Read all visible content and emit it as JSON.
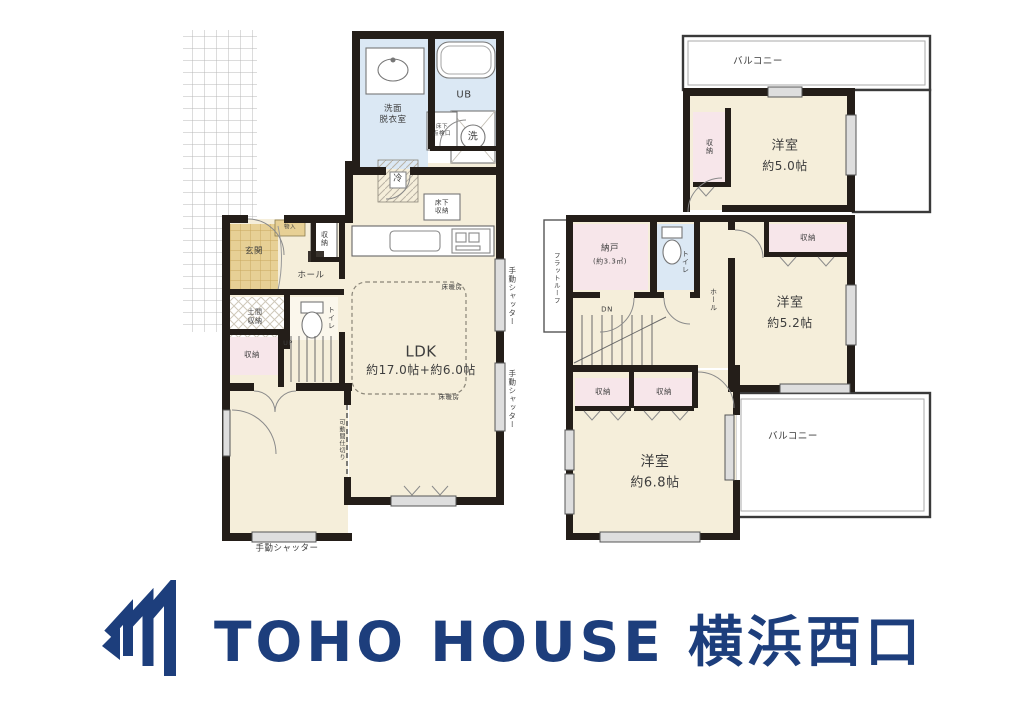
{
  "floor1": {
    "washroom": "洗面\n脱衣室",
    "unit_bath": "UB",
    "laundry": "洗",
    "underfloor_hatch": "床下\n点検口",
    "refrigerator": "冷",
    "underfloor_storage": "床下\n収納",
    "ldk_name": "LDK",
    "ldk_size": "約17.0帖+約6.0帖",
    "floor_heating": "床暖房",
    "entrance": "玄関",
    "entry_cabinet": "物入",
    "entry_storage": "収納",
    "hall": "ホール",
    "toilet": "トイレ",
    "doma_storage": "土間\n収納",
    "storage": "収納",
    "stairs_up": "UP",
    "shutter": "手動シャッター",
    "partition": "可動間仕切り"
  },
  "floor2": {
    "balcony": "バルコニー",
    "room_a_name": "洋室",
    "room_a_size": "約5.0帖",
    "room_b_name": "洋室",
    "room_b_size": "約5.2帖",
    "room_c_name": "洋室",
    "room_c_size": "約6.8帖",
    "storage": "収納",
    "storeroom_name": "納戸",
    "storeroom_size": "(約3.3㎡)",
    "toilet": "トイレ",
    "stairs_down": "DN",
    "hall": "ホール",
    "flat_roof": "フラットルーフ"
  },
  "logo": {
    "text": "TOHO HOUSE 横浜西口",
    "color": "#1d3e7c"
  },
  "palette": {
    "wall": "#241e19",
    "room": "#f5eeda",
    "wet": "#dbe8f4",
    "closet": "#f7e6ea",
    "entry": "#e7d095"
  }
}
